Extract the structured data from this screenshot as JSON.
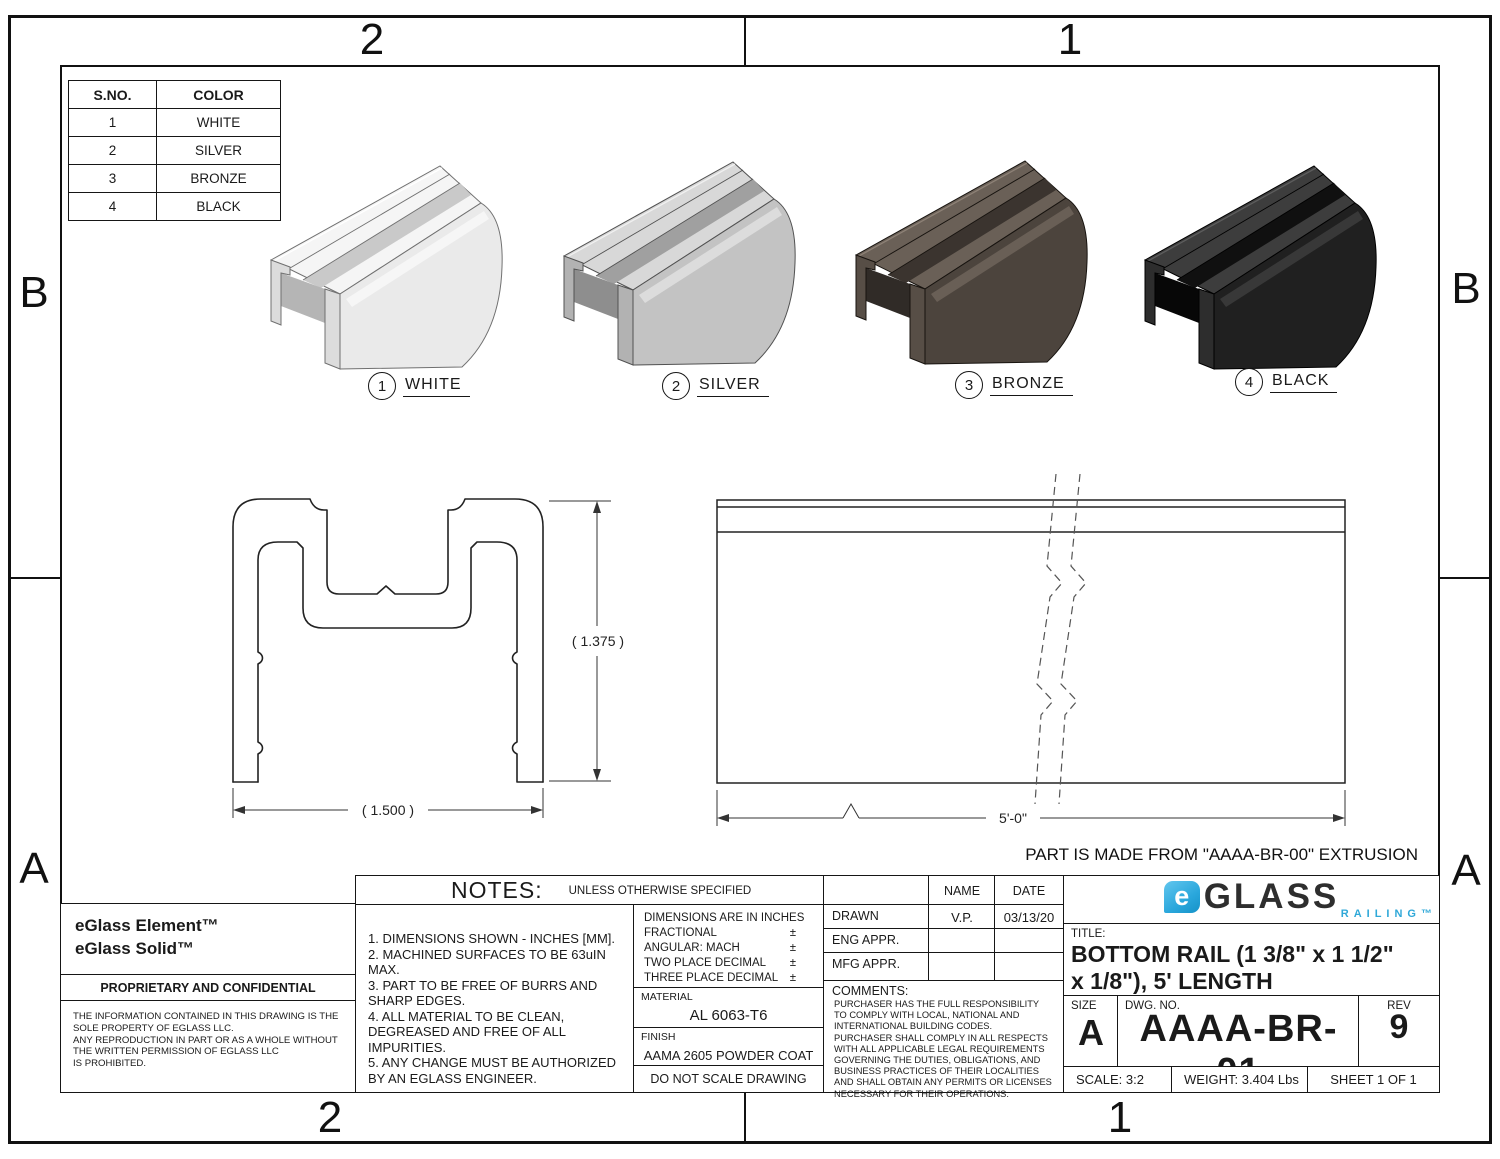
{
  "zones": {
    "top_left": "2",
    "top_right": "1",
    "bottom_left": "2",
    "bottom_right": "1",
    "left_top": "B",
    "left_bottom": "A",
    "right_top": "B",
    "right_bottom": "A"
  },
  "color_table": {
    "headers": [
      "S.NO.",
      "COLOR"
    ],
    "rows": [
      [
        "1",
        "WHITE"
      ],
      [
        "2",
        "SILVER"
      ],
      [
        "3",
        "BRONZE"
      ],
      [
        "4",
        "BLACK"
      ]
    ]
  },
  "variants": [
    {
      "num": "1",
      "label": "WHITE",
      "colors": {
        "top": "#f5f5f5",
        "body": "#eaeaea",
        "front": "#dcdcdc",
        "shadow": "#b5b5b5",
        "mouth": "#c9c9c9",
        "line": "#707070",
        "hi": "#ffffff"
      }
    },
    {
      "num": "2",
      "label": "SILVER",
      "colors": {
        "top": "#d8d8d8",
        "body": "#c3c3c3",
        "front": "#b2b2b2",
        "shadow": "#8e8e8e",
        "mouth": "#a0a0a0",
        "line": "#515151",
        "hi": "#f0f0f0"
      }
    },
    {
      "num": "3",
      "label": "BRONZE",
      "colors": {
        "top": "#6a6057",
        "body": "#4c443d",
        "front": "#574e46",
        "shadow": "#302b27",
        "mouth": "#3b342f",
        "line": "#17130f",
        "hi": "#8d8176"
      }
    },
    {
      "num": "4",
      "label": "BLACK",
      "colors": {
        "top": "#3d3d3d",
        "body": "#202020",
        "front": "#2d2d2d",
        "shadow": "#070707",
        "mouth": "#101010",
        "line": "#000000",
        "hi": "#5d5d5d"
      }
    }
  ],
  "section": {
    "height_dim": "( 1.375 )",
    "width_dim": "( 1.500 )"
  },
  "side": {
    "length_dim": "5'-0\""
  },
  "extrusion_note": "PART IS MADE FROM \"AAAA-BR-00\" EXTRUSION",
  "company": {
    "line1": "eGlass Element™",
    "line2": "eGlass Solid™"
  },
  "proprietary": {
    "title": "PROPRIETARY AND CONFIDENTIAL",
    "lines": [
      "THE INFORMATION CONTAINED IN THIS DRAWING IS THE",
      "SOLE PROPERTY OF EGLASS LLC.",
      "ANY REPRODUCTION IN PART OR AS A WHOLE WITHOUT",
      "THE WRITTEN PERMISSION OF EGLASS LLC",
      "IS PROHIBITED."
    ]
  },
  "notes": {
    "title": "NOTES:",
    "subtitle": "UNLESS OTHERWISE SPECIFIED",
    "items": [
      "1. DIMENSIONS SHOWN - INCHES [MM].",
      "2. MACHINED SURFACES TO BE 63uIN MAX.",
      "3. PART TO BE FREE OF BURRS AND SHARP EDGES.",
      "4. ALL MATERIAL TO BE CLEAN, DEGREASED AND FREE OF ALL IMPURITIES.",
      "5. ANY CHANGE MUST BE AUTHORIZED BY AN EGLASS ENGINEER."
    ]
  },
  "tolerances": {
    "line1": "DIMENSIONS ARE IN INCHES",
    "rows": [
      {
        "label": "FRACTIONAL",
        "pm": "±"
      },
      {
        "label": "ANGULAR: MACH",
        "pm": "±"
      },
      {
        "label": "TWO PLACE DECIMAL",
        "pm": "±"
      },
      {
        "label": "THREE PLACE DECIMAL",
        "pm": "±"
      }
    ]
  },
  "material": {
    "label": "MATERIAL",
    "value": "AL 6063-T6"
  },
  "finish": {
    "label": "FINISH",
    "value": "AAMA 2605 POWDER COAT"
  },
  "do_not_scale": "DO NOT SCALE DRAWING",
  "approvals": {
    "name_header": "NAME",
    "date_header": "DATE",
    "rows": [
      {
        "label": "DRAWN",
        "name": "V.P.",
        "date": "03/13/20"
      },
      {
        "label": "ENG APPR.",
        "name": "",
        "date": ""
      },
      {
        "label": "MFG APPR.",
        "name": "",
        "date": ""
      }
    ]
  },
  "comments": {
    "label": "COMMENTS:",
    "body": "PURCHASER HAS THE FULL RESPONSIBILITY TO COMPLY WITH LOCAL, NATIONAL AND INTERNATIONAL BUILDING CODES. PURCHASER SHALL COMPLY IN ALL RESPECTS WITH ALL APPLICABLE LEGAL REQUIREMENTS GOVERNING THE DUTIES, OBLIGATIONS, AND BUSINESS PRACTICES OF THEIR LOCALITIES AND SHALL OBTAIN ANY PERMITS OR LICENSES NECESSARY FOR THEIR OPERATIONS."
  },
  "logo": {
    "e": "e",
    "brand": "GLASS",
    "sub": "RAILING™",
    "accent": "#2fa8d8",
    "dark": "#2e2e2e"
  },
  "title_block": {
    "title_label": "TITLE:",
    "title_line1": "BOTTOM RAIL (1 3/8\" x 1 1/2\"",
    "title_line2": "x 1/8\"), 5' LENGTH",
    "size_label": "SIZE",
    "size": "A",
    "dwg_label": "DWG.  NO.",
    "dwg_no": "AAAA-BR-01",
    "rev_label": "REV",
    "rev": "9",
    "scale": "SCALE: 3:2",
    "weight": "WEIGHT: 3.404 Lbs",
    "sheet": "SHEET 1 OF 1"
  }
}
